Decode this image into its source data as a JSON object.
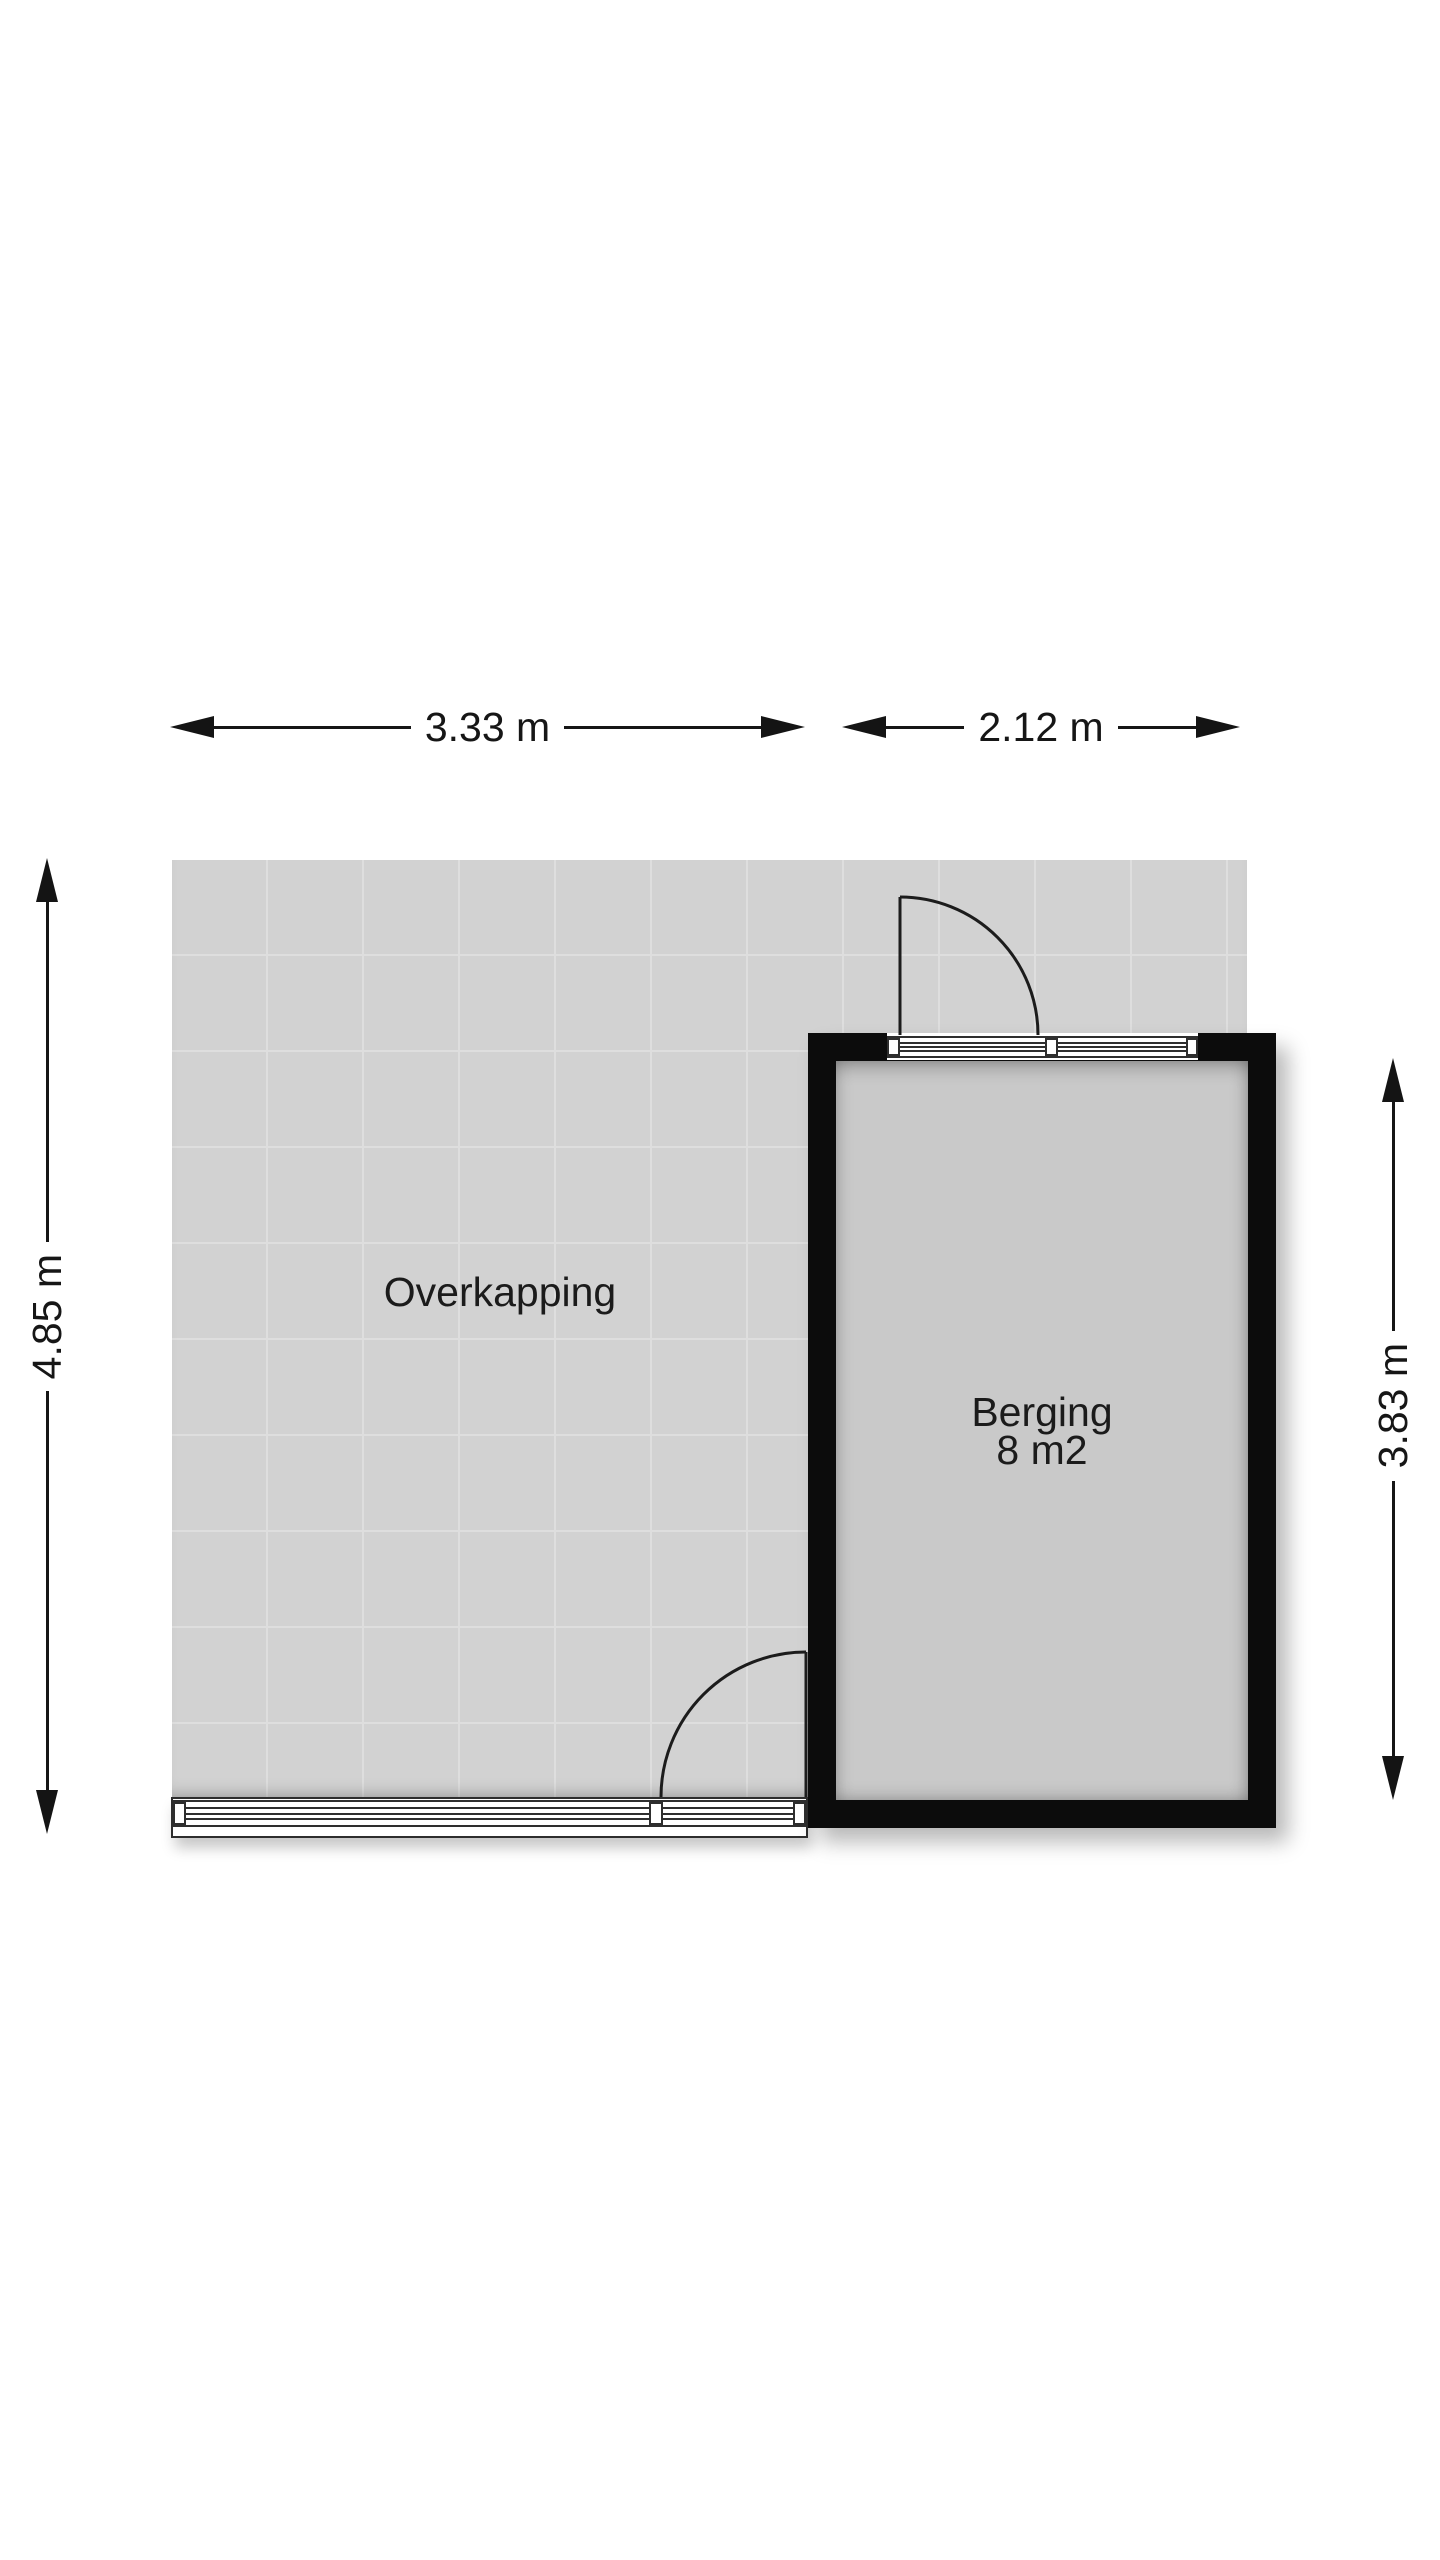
{
  "floorplan": {
    "rooms": {
      "overkapping": {
        "label": "Overkapping"
      },
      "berging": {
        "label": "Berging",
        "area": "8 m2"
      }
    },
    "dimensions": {
      "top_left": "3.33 m",
      "top_right": "2.12 m",
      "left": "4.85 m",
      "right": "3.83 m"
    },
    "colors": {
      "background": "#ffffff",
      "wall": "#0c0c0c",
      "overkapping_floor": "#d2d2d2",
      "tile_grid_line": "#dedede",
      "berging_floor": "#c9c9c9",
      "dimension_line": "#161616",
      "frame_line": "#2e2e2e"
    },
    "icons": {
      "arrowhead": "solid black triangle (dimension arrow end)",
      "door_swing_arc": "quarter-circle door swing"
    }
  }
}
